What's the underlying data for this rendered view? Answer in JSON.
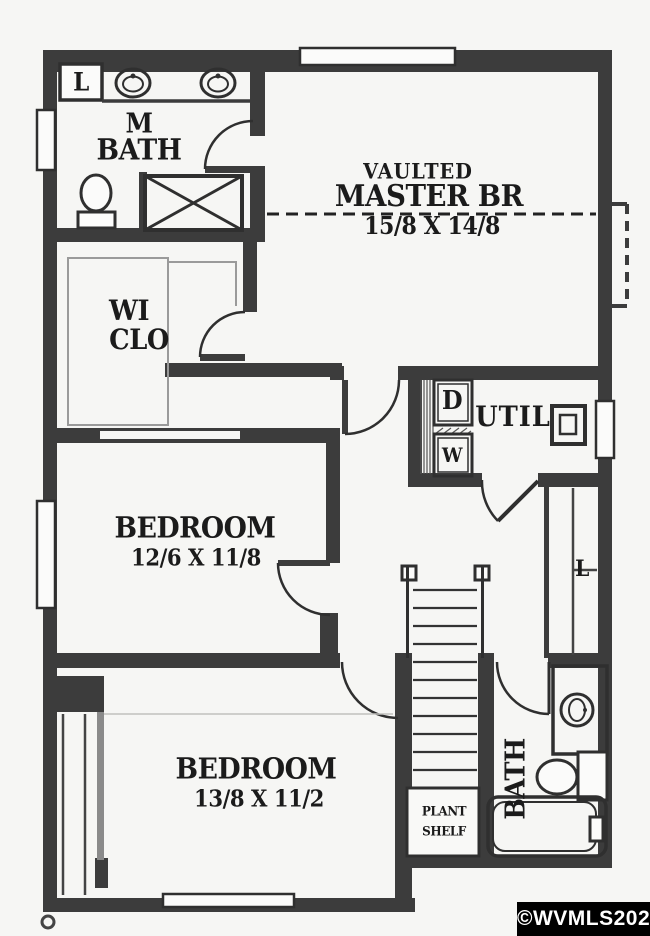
{
  "colors": {
    "wall": "#3c3c3c",
    "ink": "#2f2f2f",
    "paper": "#fbfbfa",
    "bg": "#f6f6f4",
    "text": "#1b1b1b",
    "watermark_bg": "#000000",
    "watermark_fg": "#ffffff"
  },
  "rooms": {
    "master_bath": {
      "line1": "M",
      "line2": "BATH"
    },
    "master_br": {
      "tag": "VAULTED",
      "name": "MASTER BR",
      "dims": "15/8 X 14/8"
    },
    "wi_clo": {
      "line1": "WI",
      "line2": "CLO"
    },
    "util": {
      "label": "UTIL",
      "dryer": "D",
      "washer": "W"
    },
    "bedroom1": {
      "name": "BEDROOM",
      "dims": "12/6 X 11/8"
    },
    "bedroom2": {
      "name": "BEDROOM",
      "dims": "13/8 X 11/2"
    },
    "bath2": {
      "label": "BATH"
    },
    "plant_shelf": {
      "line1": "PLANT",
      "line2": "SHELF"
    },
    "linen_master": {
      "label": "L"
    },
    "linen_hall": {
      "label": "L"
    }
  },
  "watermark": {
    "text": "©WVMLS2020"
  }
}
